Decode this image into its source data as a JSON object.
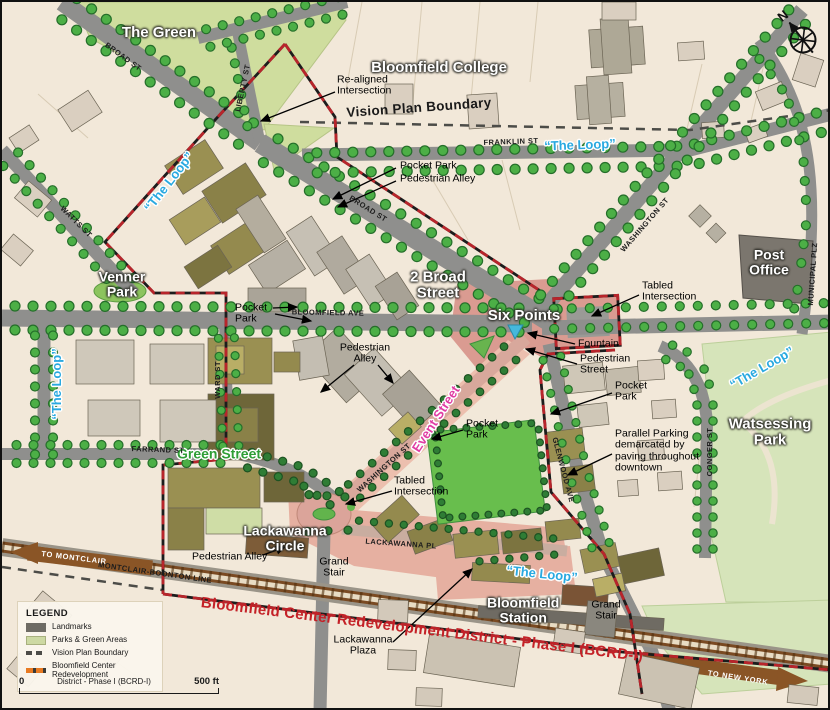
{
  "compass": {
    "label": "N"
  },
  "legend": {
    "title": "LEGEND",
    "items": [
      {
        "swatch": "landmarks",
        "label": "Landmarks",
        "color": "#6e6b64"
      },
      {
        "swatch": "parks",
        "label": "Parks & Green Areas",
        "color": "#cdd9a3"
      },
      {
        "swatch": "vision-boundary",
        "label": "Vision Plan Boundary",
        "color": "#4c4c48"
      },
      {
        "swatch": "bcrd-boundary",
        "label": "Bloomfield Center Redevelopment",
        "label2": "District - Phase I (BCRD-I)",
        "color": "#e87a22"
      }
    ]
  },
  "scale_bar": {
    "start": "0",
    "end": "500 ft"
  },
  "colors": {
    "loop_text": "#29a9e0",
    "green_street_text": "#2f9e36",
    "event_street_text": "#e03ca3",
    "bcrd_text": "#c42127",
    "bcrd_boundary": "#b8252b",
    "vision_boundary": "#4c4c48",
    "park_green": "#cfdd9e",
    "field_green": "#68be4d",
    "tree_green": "#4caf46",
    "road_gray": "#8f8f8d",
    "plaza_pink": "#da9b91",
    "rail_brown": "#7a4a22"
  },
  "map": {
    "labels": [
      {
        "style": "place",
        "text": "The Green",
        "x": 157,
        "y": 31,
        "size": 15
      },
      {
        "style": "place",
        "text": "Bloomfield College",
        "x": 437,
        "y": 66,
        "size": 15
      },
      {
        "style": "place",
        "text": "Venner\nPark",
        "x": 120,
        "y": 282,
        "size": 14
      },
      {
        "style": "place",
        "text": "2 Broad\nStreet",
        "x": 436,
        "y": 283,
        "size": 15
      },
      {
        "style": "place",
        "text": "Six Points",
        "x": 522,
        "y": 314,
        "size": 15
      },
      {
        "style": "place",
        "text": "Post\nOffice",
        "x": 767,
        "y": 260,
        "size": 14
      },
      {
        "style": "place",
        "text": "Watsessing\nPark",
        "x": 768,
        "y": 430,
        "size": 15
      },
      {
        "style": "place",
        "text": "Lackawanna\nCircle",
        "x": 283,
        "y": 536,
        "size": 14
      },
      {
        "style": "place",
        "text": "Bloomfield\nStation",
        "x": 485,
        "y": 608,
        "size": 14,
        "align": "left"
      },
      {
        "style": "loop",
        "text": "“The Loop”",
        "x": 167,
        "y": 180,
        "rot": -52
      },
      {
        "style": "loop",
        "text": "“The Loop”",
        "x": 578,
        "y": 143,
        "rot": -2
      },
      {
        "style": "loop",
        "text": "“The Loop”",
        "x": 55,
        "y": 382,
        "rot": -90
      },
      {
        "style": "loop",
        "text": "“The Loop”",
        "x": 760,
        "y": 366,
        "rot": -30
      },
      {
        "style": "loop",
        "text": "“The Loop”",
        "x": 540,
        "y": 572,
        "rot": 6
      },
      {
        "style": "green",
        "text": "Green Street",
        "x": 217,
        "y": 452
      },
      {
        "style": "event",
        "text": "Event Street",
        "x": 434,
        "y": 417,
        "rot": -57
      },
      {
        "style": "street",
        "text": "BROAD ST",
        "x": 121,
        "y": 55,
        "rot": 36
      },
      {
        "style": "street",
        "text": "LIBERTY ST",
        "x": 241,
        "y": 86,
        "rot": -78
      },
      {
        "style": "street",
        "text": "FRANKLIN ST",
        "x": 509,
        "y": 140,
        "rot": -2
      },
      {
        "style": "street",
        "text": "BROAD ST",
        "x": 366,
        "y": 207,
        "rot": 32
      },
      {
        "style": "street",
        "text": "WASHINGTON ST",
        "x": 643,
        "y": 223,
        "rot": -49
      },
      {
        "style": "street",
        "text": "MUNICIPAL PLZ",
        "x": 811,
        "y": 272,
        "rot": -86
      },
      {
        "style": "street",
        "text": "WATTS ST",
        "x": 74,
        "y": 220,
        "rot": 45
      },
      {
        "style": "street",
        "text": "BLOOMFIELD AVE",
        "x": 326,
        "y": 311,
        "rot": 1
      },
      {
        "style": "street",
        "text": "WARD ST",
        "x": 216,
        "y": 378,
        "rot": -90
      },
      {
        "style": "street",
        "text": "FARRAND ST",
        "x": 156,
        "y": 448,
        "rot": 2
      },
      {
        "style": "street",
        "text": "WASHINGTON ST",
        "x": 382,
        "y": 466,
        "rot": -42
      },
      {
        "style": "street",
        "text": "GLENWOOD AVE",
        "x": 561,
        "y": 468,
        "rot": 75
      },
      {
        "style": "street",
        "text": "CONGER ST",
        "x": 708,
        "y": 450,
        "rot": -90
      },
      {
        "style": "street",
        "text": "LACKAWANNA PL",
        "x": 399,
        "y": 542,
        "rot": 4
      },
      {
        "style": "street",
        "text": "MONTCLAIR-BOONTON LINE",
        "x": 153,
        "y": 571,
        "rot": 8
      },
      {
        "style": "rail",
        "text": "TO MONTCLAIR",
        "x": 72,
        "y": 556,
        "rot": 7
      },
      {
        "style": "rail",
        "text": "TO NEW YORK",
        "x": 736,
        "y": 676,
        "rot": 9
      },
      {
        "style": "annobold",
        "text": "Vision Plan Boundary",
        "x": 417,
        "y": 106,
        "rot": -4
      },
      {
        "style": "bcrd",
        "text": "Bloomfield Center Redevelopment District - Phase I (BCRD-I)",
        "x": 420,
        "y": 628,
        "rot": 7
      },
      {
        "style": "anno",
        "text": "Re-aligned\nIntersection",
        "x": 335,
        "y": 84,
        "align": "left"
      },
      {
        "style": "anno",
        "text": "Pocket Park",
        "x": 398,
        "y": 164,
        "align": "left"
      },
      {
        "style": "anno",
        "text": "Pedestrian Alley",
        "x": 398,
        "y": 177,
        "align": "left"
      },
      {
        "style": "anno",
        "text": "Tabled\nIntersection",
        "x": 640,
        "y": 290,
        "align": "left"
      },
      {
        "style": "anno",
        "text": "Fountain",
        "x": 576,
        "y": 342,
        "align": "left"
      },
      {
        "style": "anno",
        "text": "Pedestrian\nStreet",
        "x": 578,
        "y": 363,
        "align": "left"
      },
      {
        "style": "anno",
        "text": "Pocket\nPark",
        "x": 613,
        "y": 390,
        "align": "left"
      },
      {
        "style": "anno",
        "text": "Parallel Parking\ndemarcated by\npaving throughout\ndowntown",
        "x": 613,
        "y": 449,
        "align": "left"
      },
      {
        "style": "anno",
        "text": "Pocket\nPark",
        "x": 464,
        "y": 428,
        "align": "left"
      },
      {
        "style": "anno",
        "text": "Pedestrian\nAlley",
        "x": 363,
        "y": 352
      },
      {
        "style": "anno",
        "text": "Pocket\nPark",
        "x": 233,
        "y": 312,
        "align": "left"
      },
      {
        "style": "anno",
        "text": "Tabled\nIntersection",
        "x": 392,
        "y": 485,
        "align": "left"
      },
      {
        "style": "anno",
        "text": "Pedestrian Alley",
        "x": 190,
        "y": 555,
        "align": "left"
      },
      {
        "style": "anno",
        "text": "Grand\nStair",
        "x": 332,
        "y": 566
      },
      {
        "style": "anno",
        "text": "Grand\nStair",
        "x": 604,
        "y": 609
      },
      {
        "style": "anno",
        "text": "Lackawanna\nPlaza",
        "x": 361,
        "y": 644
      }
    ]
  }
}
